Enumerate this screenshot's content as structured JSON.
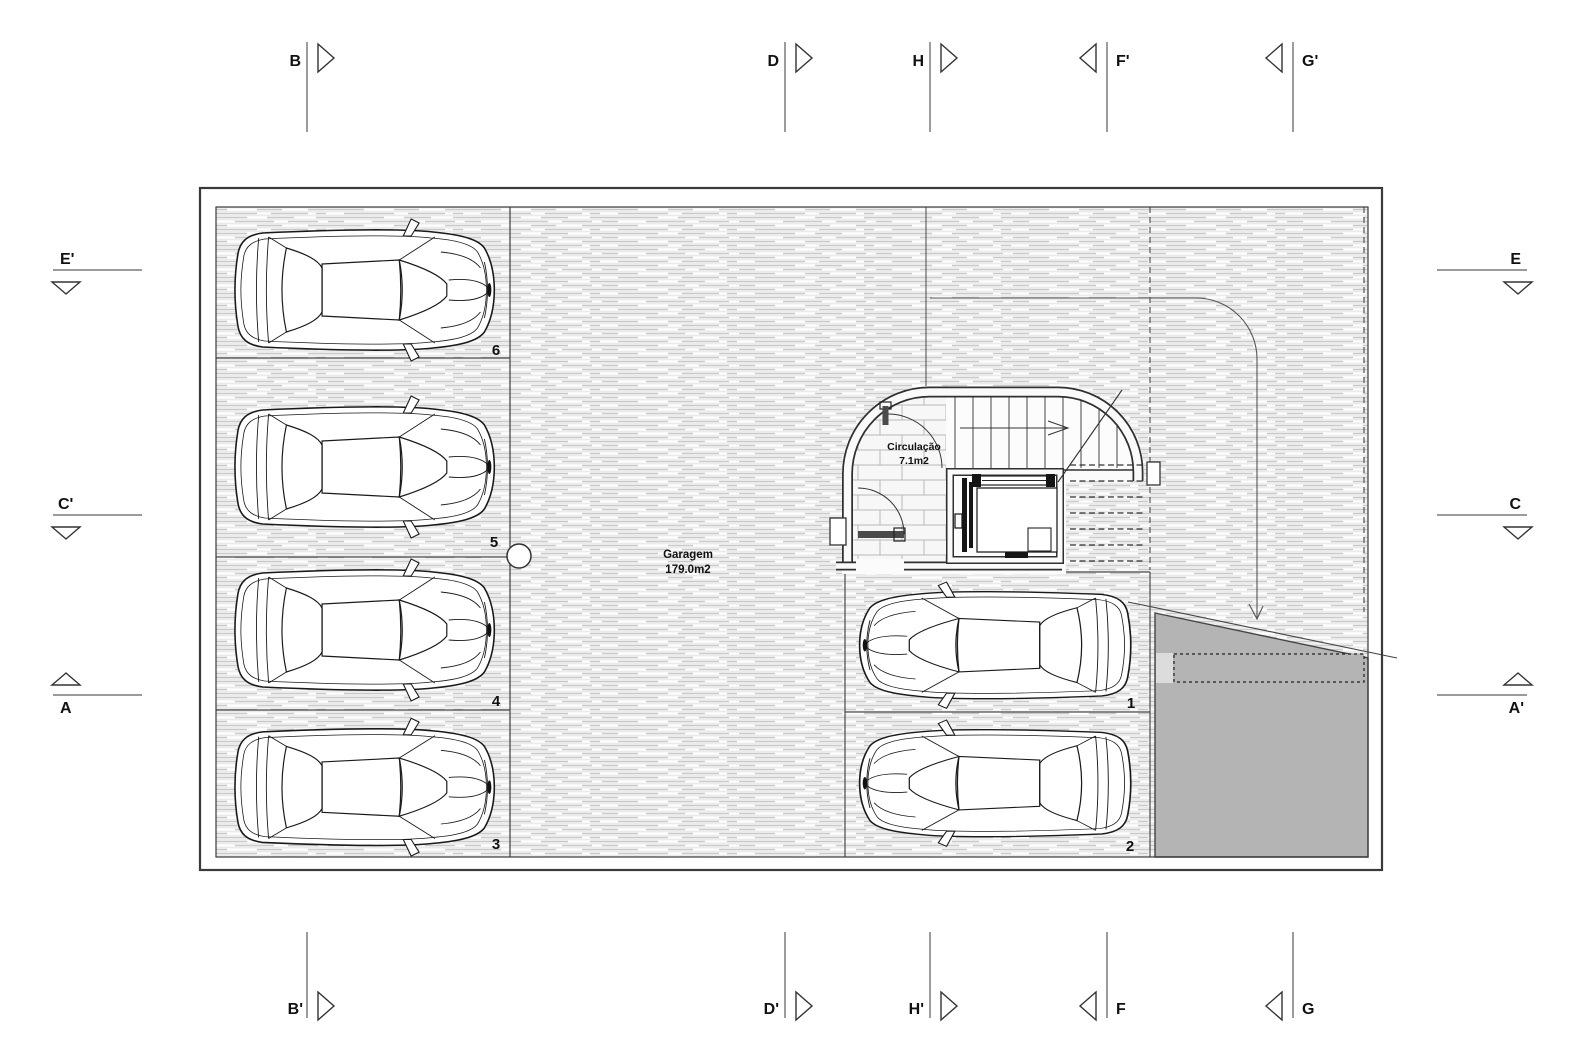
{
  "plan": {
    "garagem": {
      "label": "Garagem",
      "area": "179.0m2"
    },
    "circulacao": {
      "label": "Circulação",
      "area": "7.1m2"
    },
    "stall_numbers": {
      "s1": "1",
      "s2": "2",
      "s3": "3",
      "s4": "4",
      "s5": "5",
      "s6": "6"
    }
  },
  "markers": {
    "top": {
      "b": "B",
      "d": "D",
      "h": "H",
      "f_p": "F'",
      "g_p": "G'"
    },
    "bottom": {
      "b_p": "B'",
      "d_p": "D'",
      "h_p": "H'",
      "f": "F",
      "g": "G"
    },
    "left": {
      "e_p": "E'",
      "c_p": "C'",
      "a": "A"
    },
    "right": {
      "e": "E",
      "c": "C",
      "a_p": "A'"
    }
  },
  "colors": {
    "ramp_gray": "#b4b4b4",
    "wall_line": "#333333",
    "hatch_line": "#c9c9c9"
  }
}
